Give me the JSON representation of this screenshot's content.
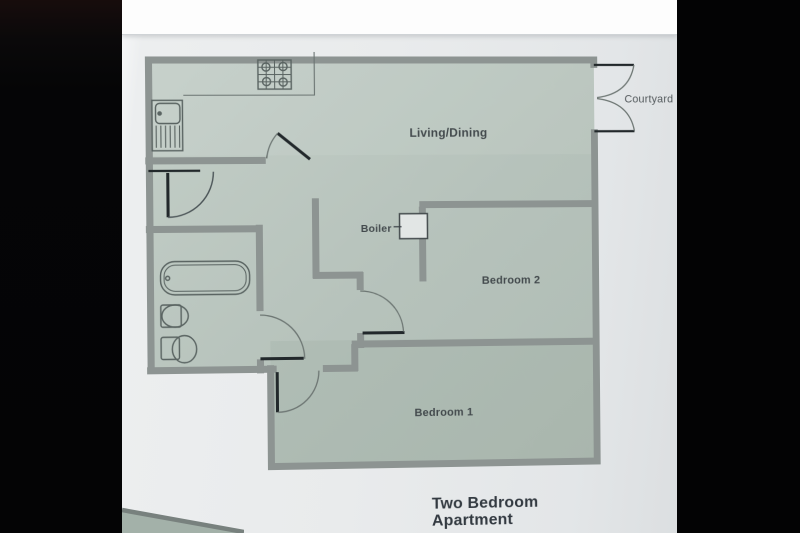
{
  "caption": {
    "line1": "Two Bedroom",
    "line2": "Apartment"
  },
  "labels": {
    "living_dining": "Living/Dining",
    "bedroom2": "Bedroom 2",
    "bedroom1": "Bedroom 1",
    "boiler": "Boiler",
    "courtyard": "Courtyard"
  },
  "fixtures": [
    "hob-icon",
    "kitchen-sink-icon",
    "bathtub-icon",
    "basin-icon",
    "toilet-icon",
    "boiler-unit"
  ],
  "doors": [
    "hall-door",
    "kitchen-door",
    "bathroom-door",
    "bedroom-1-door",
    "bedroom-2-door",
    "courtyard-french-doors"
  ],
  "colors": {
    "floor_light": "#c3cec7",
    "floor_dark": "#afbcb4",
    "wall": "#8d9492",
    "paper": "#e9ebec",
    "ink": "#434a4d",
    "door_black": "#22282b",
    "fixture_line": "#5a6462",
    "black_bar": "#060607",
    "under_sheet": "#a3b1a9"
  }
}
